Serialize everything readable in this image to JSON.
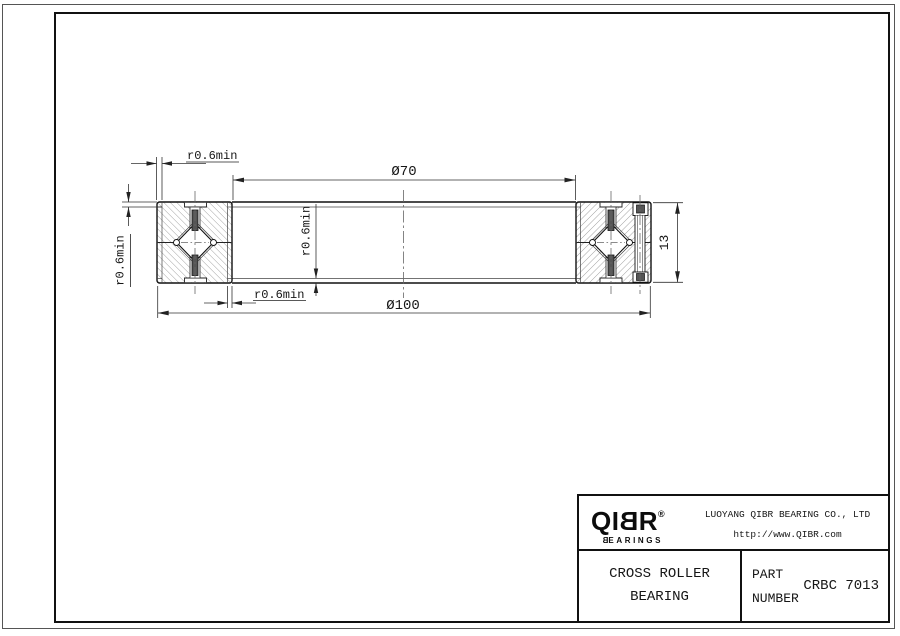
{
  "drawing": {
    "dimensions": {
      "bore_diameter": "Ø70",
      "outer_diameter": "Ø100",
      "section_width": "13",
      "chamfer": "r0.6min"
    },
    "colors": {
      "outline": "#111111",
      "dimension_line": "#333333",
      "hatch": "#8f8f8f",
      "centerline": "#666666"
    }
  },
  "title_block": {
    "logo": {
      "part1": "QI",
      "flipped_letter": "B",
      "part2": "R",
      "registered": "®",
      "subtitle_flipped": "B",
      "subtitle_rest": "EARINGS"
    },
    "company": "LUOYANG QIBR BEARING CO., LTD",
    "website": "http://www.QIBR.com",
    "product_line1": "CROSS ROLLER",
    "product_line2": "BEARING",
    "part_label_line1": "PART",
    "part_label_line2": "NUMBER",
    "part_number": "CRBC 7013"
  }
}
